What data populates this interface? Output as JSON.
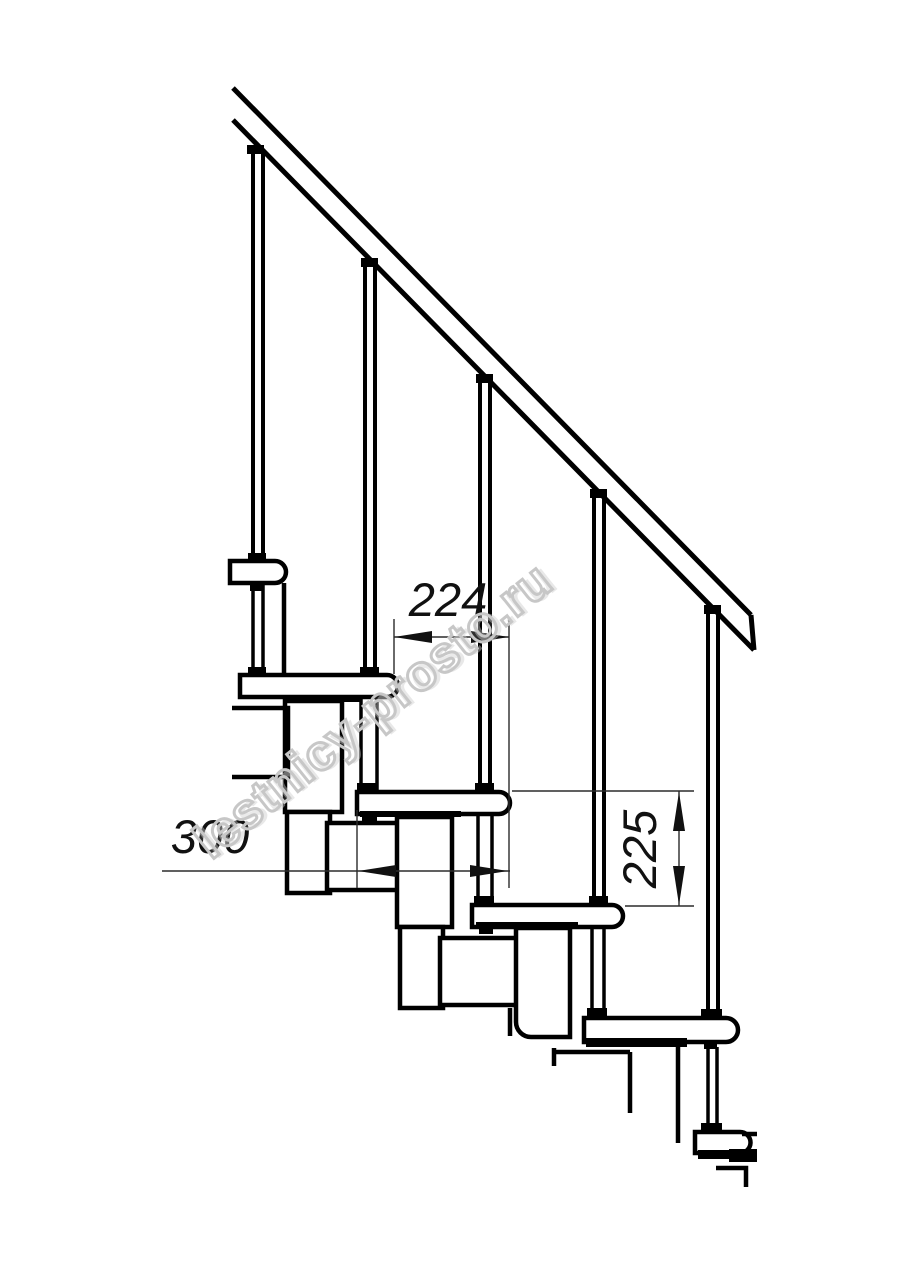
{
  "watermark": {
    "text": "lestnicy-prosto.ru"
  },
  "dimensions": {
    "step_run": "224",
    "tread_depth": "300",
    "step_rise": "225"
  },
  "colors": {
    "line": "#000000",
    "dimension_line": "#2b2b2b",
    "background": "#ffffff",
    "watermark_outline": "#c7c7c7"
  }
}
